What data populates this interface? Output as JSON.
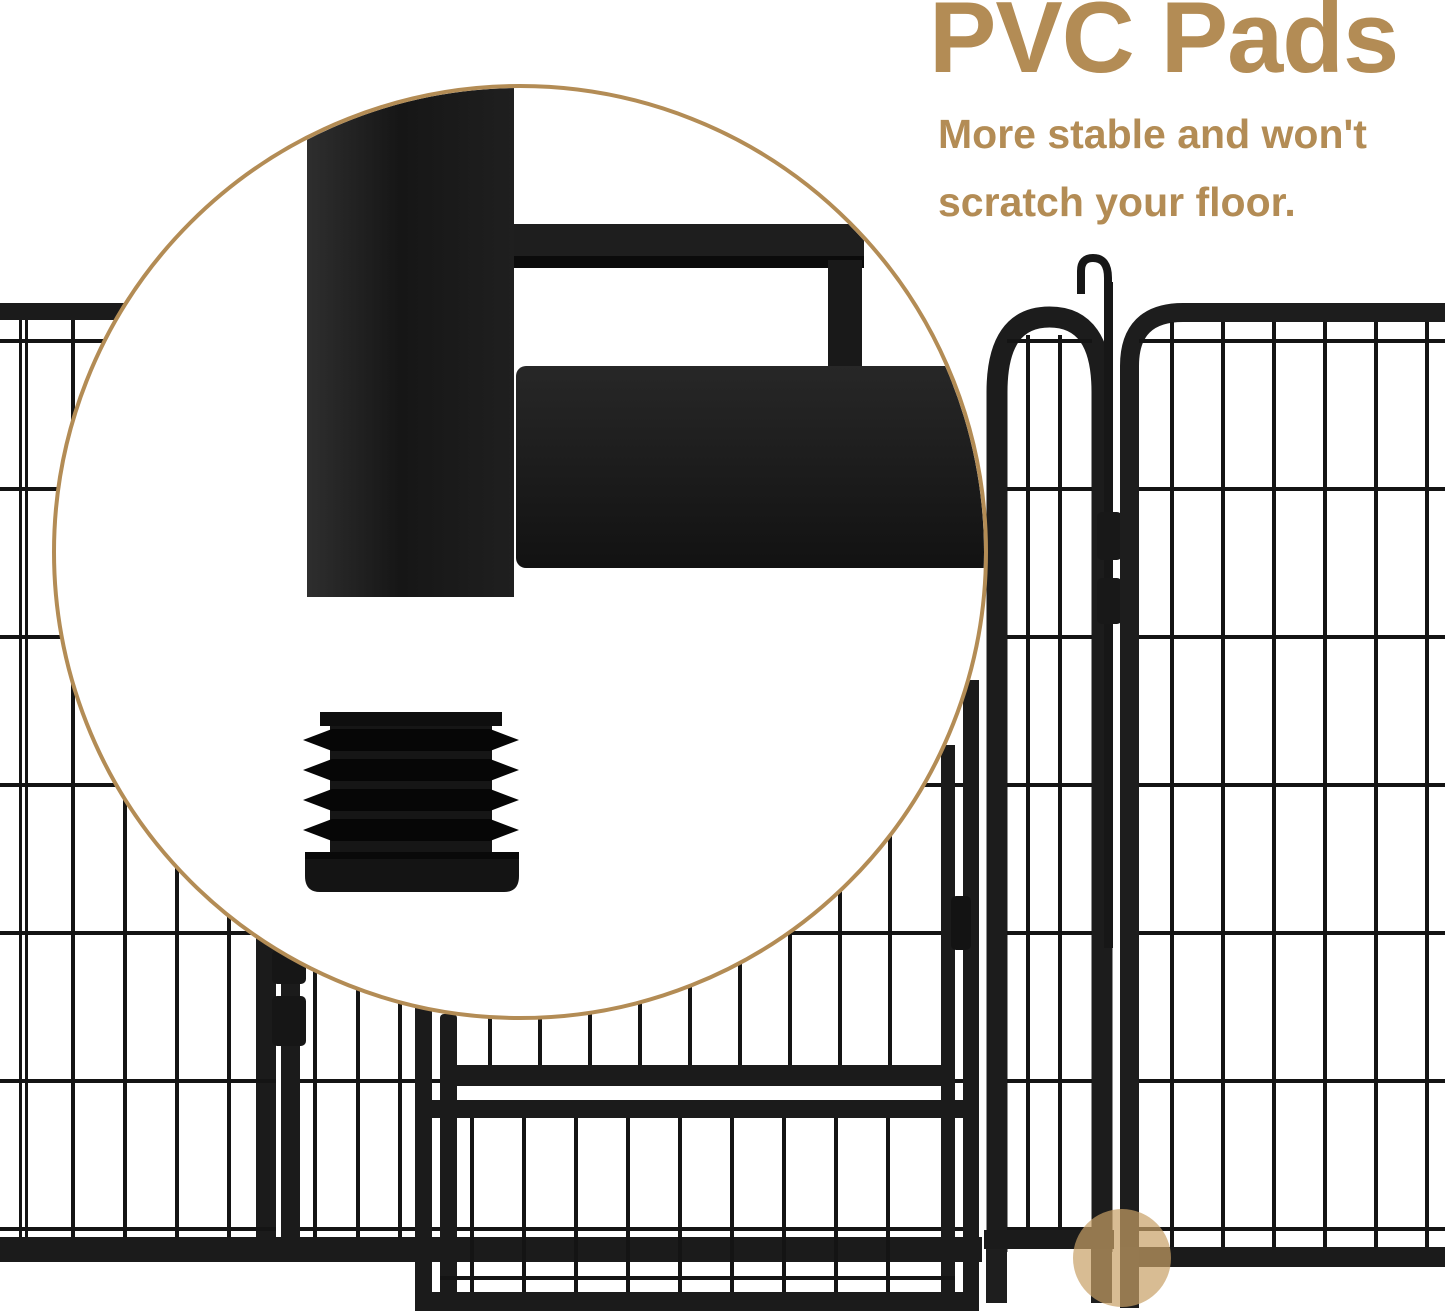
{
  "headline": {
    "title": "PVC Pads",
    "subtitle_line1": "More stable and won't",
    "subtitle_line2": "scratch your floor."
  },
  "colors": {
    "accent_tan": "#b38c55",
    "highlight_circle": "#c89f65",
    "fence_black": "#1b1b1b",
    "background": "#ffffff"
  },
  "illustration": {
    "magnifier_subject": "pvc-pad-and-frame-corner-closeup",
    "highlight_subject": "pad-location-on-fence-foot"
  }
}
